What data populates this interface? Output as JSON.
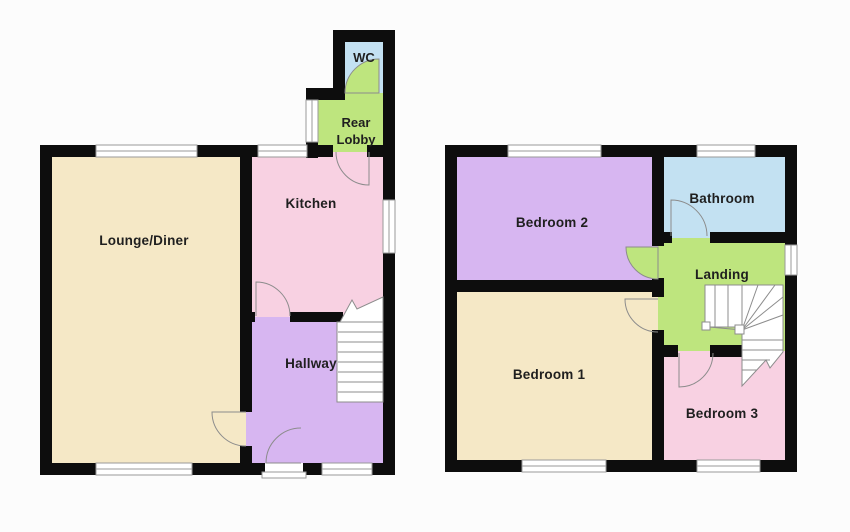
{
  "document_title": "Two storey house floor plan",
  "colors": {
    "background": "#fcfcfc",
    "wall": "#0d0d0d",
    "room_beige": "#f5e8c6",
    "room_pink": "#f8d1e2",
    "room_purple": "#d7b6f1",
    "room_green": "#bee57e",
    "room_blue": "#c3e1f2",
    "window_fill": "#ffffff",
    "stairs_fill": "#ffffff",
    "label_text": "#1f1f1f"
  },
  "ground_floor": {
    "rooms": {
      "wc": {
        "label": "WC"
      },
      "rear_lobby": {
        "lines": [
          "Rear",
          "Lobby"
        ]
      },
      "kitchen": {
        "label": "Kitchen"
      },
      "lounge_diner": {
        "label": "Lounge/Diner"
      },
      "hallway": {
        "label": "Hallway"
      }
    }
  },
  "first_floor": {
    "rooms": {
      "bedroom_2": {
        "label": "Bedroom 2"
      },
      "bathroom": {
        "label": "Bathroom"
      },
      "landing": {
        "label": "Landing"
      },
      "bedroom_1": {
        "label": "Bedroom 1"
      },
      "bedroom_3": {
        "label": "Bedroom 3"
      }
    }
  }
}
